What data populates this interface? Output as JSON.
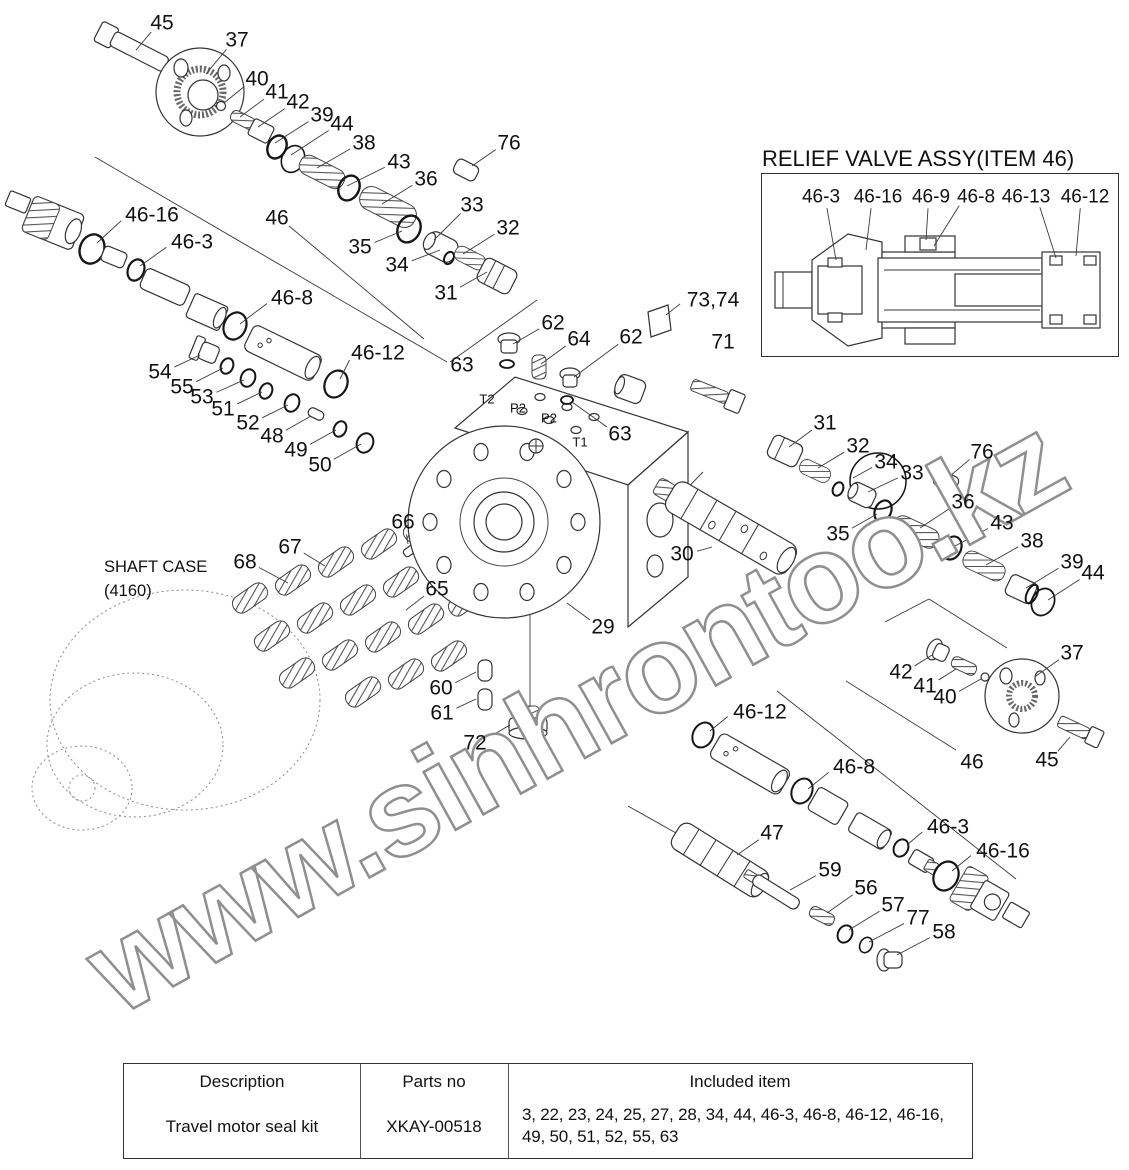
{
  "diagram": {
    "watermark": "www.sinhrontoo.kz",
    "relief_box": {
      "title": "RELIEF VALVE ASSY(ITEM 46)"
    },
    "shaft_case": {
      "line1": "SHAFT CASE",
      "line2": "(4160)"
    },
    "labels": [
      {
        "t": "45",
        "x": 162,
        "y": 23,
        "lx": 136,
        "ly": 50
      },
      {
        "t": "37",
        "x": 237,
        "y": 40,
        "lx": 206,
        "ly": 74
      },
      {
        "t": "40",
        "x": 257,
        "y": 79,
        "lx": 224,
        "ly": 103
      },
      {
        "t": "41",
        "x": 277,
        "y": 92,
        "lx": 240,
        "ly": 117
      },
      {
        "t": "42",
        "x": 298,
        "y": 102,
        "lx": 258,
        "ly": 127
      },
      {
        "t": "39",
        "x": 322,
        "y": 115,
        "lx": 275,
        "ly": 143
      },
      {
        "t": "44",
        "x": 342,
        "y": 124,
        "lx": 291,
        "ly": 155
      },
      {
        "t": "38",
        "x": 364,
        "y": 143,
        "lx": 317,
        "ly": 168
      },
      {
        "t": "43",
        "x": 399,
        "y": 162,
        "lx": 347,
        "ly": 186
      },
      {
        "t": "36",
        "x": 426,
        "y": 179,
        "lx": 382,
        "ly": 204
      },
      {
        "t": "33",
        "x": 472,
        "y": 205,
        "lx": 434,
        "ly": 240
      },
      {
        "t": "32",
        "x": 508,
        "y": 228,
        "lx": 463,
        "ly": 254
      },
      {
        "t": "35",
        "x": 360,
        "y": 247,
        "lx": 402,
        "ly": 231
      },
      {
        "t": "34",
        "x": 397,
        "y": 265,
        "lx": 440,
        "ly": 250
      },
      {
        "t": "31",
        "x": 446,
        "y": 293,
        "lx": 487,
        "ly": 272
      },
      {
        "t": "76",
        "x": 509,
        "y": 143,
        "lx": 472,
        "ly": 166
      },
      {
        "t": "46-16",
        "x": 152,
        "y": 215,
        "lx": 97,
        "ly": 243
      },
      {
        "t": "46",
        "x": 277,
        "y": 218,
        "lx": 424,
        "ly": 339
      },
      {
        "t": "46-3",
        "x": 192,
        "y": 242,
        "lx": 140,
        "ly": 266
      },
      {
        "t": "46-8",
        "x": 292,
        "y": 298,
        "lx": 240,
        "ly": 324
      },
      {
        "t": "46-12",
        "x": 378,
        "y": 353,
        "lx": 340,
        "ly": 379
      },
      {
        "t": "54",
        "x": 160,
        "y": 372,
        "lx": 200,
        "ly": 355
      },
      {
        "t": "55",
        "x": 182,
        "y": 387,
        "lx": 223,
        "ly": 368
      },
      {
        "t": "53",
        "x": 202,
        "y": 397,
        "lx": 244,
        "ly": 380
      },
      {
        "t": "51",
        "x": 223,
        "y": 409,
        "lx": 262,
        "ly": 392
      },
      {
        "t": "52",
        "x": 248,
        "y": 423,
        "lx": 288,
        "ly": 405
      },
      {
        "t": "48",
        "x": 272,
        "y": 436,
        "lx": 311,
        "ly": 416
      },
      {
        "t": "49",
        "x": 296,
        "y": 450,
        "lx": 336,
        "ly": 430
      },
      {
        "t": "50",
        "x": 320,
        "y": 465,
        "lx": 361,
        "ly": 444
      },
      {
        "t": "62",
        "x": 553,
        "y": 323,
        "lx": 513,
        "ly": 344
      },
      {
        "t": "64",
        "x": 579,
        "y": 339,
        "lx": 541,
        "ly": 364
      },
      {
        "t": "62",
        "x": 631,
        "y": 337,
        "lx": 574,
        "ly": 377
      },
      {
        "t": "63",
        "x": 462,
        "y": 365
      },
      {
        "t": "73,74",
        "x": 713,
        "y": 300,
        "lx": 666,
        "ly": 315
      },
      {
        "t": "71",
        "x": 723,
        "y": 342
      },
      {
        "t": "T2",
        "x": 487,
        "y": 399,
        "s": 13
      },
      {
        "t": "P2",
        "x": 518,
        "y": 408,
        "s": 13
      },
      {
        "t": "P2",
        "x": 549,
        "y": 418,
        "s": 13
      },
      {
        "t": "T1",
        "x": 580,
        "y": 442,
        "s": 13
      },
      {
        "t": "63",
        "x": 620,
        "y": 434,
        "lx": 572,
        "ly": 402
      },
      {
        "t": "31",
        "x": 825,
        "y": 423,
        "lx": 789,
        "ly": 447
      },
      {
        "t": "32",
        "x": 858,
        "y": 446,
        "lx": 818,
        "ly": 468
      },
      {
        "t": "34",
        "x": 886,
        "y": 462,
        "lx": 853,
        "ly": 478
      },
      {
        "t": "33",
        "x": 912,
        "y": 473,
        "lx": 868,
        "ly": 492
      },
      {
        "t": "35",
        "x": 838,
        "y": 534,
        "lx": 877,
        "ly": 514
      },
      {
        "t": "30",
        "x": 682,
        "y": 554,
        "lx": 712,
        "ly": 547
      },
      {
        "t": "76",
        "x": 982,
        "y": 452,
        "lx": 950,
        "ly": 476
      },
      {
        "t": "36",
        "x": 963,
        "y": 502,
        "lx": 920,
        "ly": 528
      },
      {
        "t": "43",
        "x": 1002,
        "y": 523,
        "lx": 955,
        "ly": 546
      },
      {
        "t": "38",
        "x": 1032,
        "y": 541,
        "lx": 986,
        "ly": 565
      },
      {
        "t": "39",
        "x": 1072,
        "y": 562,
        "lx": 1026,
        "ly": 588
      },
      {
        "t": "44",
        "x": 1093,
        "y": 573,
        "lx": 1048,
        "ly": 600
      },
      {
        "t": "42",
        "x": 901,
        "y": 672,
        "lx": 932,
        "ly": 655
      },
      {
        "t": "41",
        "x": 925,
        "y": 686,
        "lx": 956,
        "ly": 669
      },
      {
        "t": "40",
        "x": 945,
        "y": 697,
        "lx": 981,
        "ly": 679
      },
      {
        "t": "37",
        "x": 1072,
        "y": 653,
        "lx": 1036,
        "ly": 676
      },
      {
        "t": "45",
        "x": 1047,
        "y": 760,
        "lx": 1070,
        "ly": 737
      },
      {
        "t": "46",
        "x": 972,
        "y": 762
      },
      {
        "t": "46-12",
        "x": 760,
        "y": 712,
        "lx": 710,
        "ly": 731
      },
      {
        "t": "46-8",
        "x": 854,
        "y": 767,
        "lx": 808,
        "ly": 789
      },
      {
        "t": "46-3",
        "x": 948,
        "y": 827,
        "lx": 907,
        "ly": 845
      },
      {
        "t": "46-16",
        "x": 1003,
        "y": 851,
        "lx": 952,
        "ly": 871
      },
      {
        "t": "47",
        "x": 772,
        "y": 833,
        "lx": 737,
        "ly": 855
      },
      {
        "t": "59",
        "x": 830,
        "y": 870,
        "lx": 790,
        "ly": 890
      },
      {
        "t": "56",
        "x": 866,
        "y": 888,
        "lx": 827,
        "ly": 913
      },
      {
        "t": "57",
        "x": 893,
        "y": 905,
        "lx": 849,
        "ly": 930
      },
      {
        "t": "77",
        "x": 918,
        "y": 918,
        "lx": 869,
        "ly": 942
      },
      {
        "t": "58",
        "x": 944,
        "y": 932,
        "lx": 897,
        "ly": 955
      },
      {
        "t": "66",
        "x": 403,
        "y": 522,
        "lx": 408,
        "ly": 544
      },
      {
        "t": "67",
        "x": 290,
        "y": 547,
        "lx": 325,
        "ly": 566
      },
      {
        "t": "68",
        "x": 245,
        "y": 562,
        "lx": 288,
        "ly": 583
      },
      {
        "t": "65",
        "x": 437,
        "y": 589,
        "lx": 406,
        "ly": 610
      },
      {
        "t": "29",
        "x": 603,
        "y": 627,
        "lx": 567,
        "ly": 603
      },
      {
        "t": "60",
        "x": 441,
        "y": 688,
        "lx": 476,
        "ly": 672
      },
      {
        "t": "61",
        "x": 442,
        "y": 713,
        "lx": 476,
        "ly": 699
      },
      {
        "t": "72",
        "x": 475,
        "y": 743,
        "lx": 510,
        "ly": 725
      },
      {
        "t": "SHAFT CASE",
        "x": 104,
        "y": 567,
        "s": 16.5,
        "a": "l"
      },
      {
        "t": "(4160)",
        "x": 104,
        "y": 591,
        "s": 16.5,
        "a": "l"
      },
      {
        "t": "RELIEF VALVE ASSY(ITEM 46)",
        "x": 762,
        "y": 159,
        "s": 22,
        "a": "l"
      },
      {
        "t": "46-3",
        "x": 821,
        "y": 197,
        "s": 19,
        "lx": 836,
        "ly": 260
      },
      {
        "t": "46-16",
        "x": 878,
        "y": 197,
        "s": 19,
        "lx": 866,
        "ly": 250
      },
      {
        "t": "46-9",
        "x": 931,
        "y": 197,
        "s": 19,
        "lx": 926,
        "ly": 240
      },
      {
        "t": "46-8",
        "x": 976,
        "y": 197,
        "s": 19,
        "lx": 934,
        "ly": 246
      },
      {
        "t": "46-13",
        "x": 1026,
        "y": 197,
        "s": 19,
        "lx": 1056,
        "ly": 258
      },
      {
        "t": "46-12",
        "x": 1085,
        "y": 197,
        "s": 19,
        "lx": 1076,
        "ly": 256
      }
    ]
  },
  "table": {
    "headers": [
      "Description",
      "Parts no",
      "Included item"
    ],
    "rows": [
      {
        "description": "Travel motor seal kit",
        "parts_no": "XKAY-00518",
        "included_item": "3, 22, 23, 24, 25, 27, 28, 34, 44, 46-3, 46-8, 46-12, 46-16, 49, 50, 51, 52, 55, 63"
      }
    ]
  }
}
